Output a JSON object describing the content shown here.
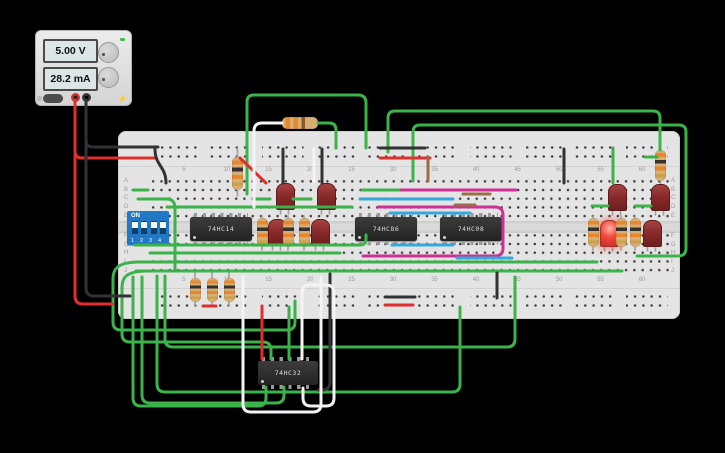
{
  "power_supply": {
    "voltage": "5.00 V",
    "current": "28.2 mA",
    "bolt_icon": "⚡"
  },
  "breadboard": {
    "row_labels_top": [
      "A",
      "B",
      "C",
      "D",
      "E"
    ],
    "row_labels_bottom": [
      "F",
      "G",
      "H",
      "I",
      "J"
    ],
    "column_labels": [
      5,
      10,
      15,
      20,
      25,
      30,
      35,
      40,
      45,
      50,
      55,
      60
    ]
  },
  "dip_switch": {
    "on_label": "ON",
    "positions_label": "1 2 3 4"
  },
  "ics": [
    {
      "label": "74HC14"
    },
    {
      "label": "74HC86"
    },
    {
      "label": "74HC08"
    },
    {
      "label": "74HC32"
    }
  ],
  "colors": {
    "g": "#3cb24a",
    "r": "#e02f2f",
    "k": "#323232",
    "w": "#f4f4f4",
    "m": "#cf3093",
    "c": "#35a7dc",
    "b": "#9c6b4a",
    "ld": "#9f9f9f",
    "board": "#e4e4e4",
    "dip_blue": "#2178c4",
    "led_lit": "#f4483c"
  },
  "wires": [
    {
      "n": "lead-led-1",
      "c": "ld",
      "l": "u",
      "p": "M280.5,205 V214 M288.5,205 V214"
    },
    {
      "n": "lead-led-2",
      "c": "ld",
      "l": "u",
      "p": "M321.5,205 V214 M329.5,205 V214"
    },
    {
      "n": "lead-led-3",
      "c": "ld",
      "l": "u",
      "p": "M272.5,241 V250 M280.5,241 V250"
    },
    {
      "n": "lead-led-4",
      "c": "ld",
      "l": "u",
      "p": "M315.5,241 V250 M323.5,241 V250"
    },
    {
      "n": "lead-led-5",
      "c": "ld",
      "l": "u",
      "p": "M612.5,206 V215 M620.5,206 V215"
    },
    {
      "n": "lead-led-6",
      "c": "ld",
      "l": "u",
      "p": "M655.5,206 V215 M663.5,206 V215"
    },
    {
      "n": "lead-led-7",
      "c": "ld",
      "l": "u",
      "p": "M604.5,242 V251 M612.5,242 V251"
    },
    {
      "n": "lead-led-8",
      "c": "ld",
      "l": "u",
      "p": "M647.5,242 V251 M655.5,242 V251"
    },
    {
      "n": "lead-res-top10",
      "c": "ld",
      "l": "u",
      "p": "M237.5,148 V196"
    },
    {
      "n": "lead-res-top61",
      "c": "ld",
      "l": "u",
      "p": "M660.5,149 V186"
    },
    {
      "n": "lead-res-bl",
      "c": "ld",
      "l": "u",
      "p": "M195,271 V306 M212,271 V306 M229,271 V306"
    },
    {
      "n": "lead-res-mid",
      "c": "ld",
      "l": "u",
      "p": "M262,216 V250 M288,216 V250 M304,216 V250"
    },
    {
      "n": "lead-res-right",
      "c": "ld",
      "l": "u",
      "p": "M593,216 V250 M621,216 V250 M635,216 V250"
    },
    {
      "n": "wire-green-arc-1",
      "c": "g",
      "l": "o",
      "p": "M247,194 V102 Q247,95 254,95 H358 Q366,95 366,103 V148"
    },
    {
      "n": "wire-green-arc-2",
      "c": "g",
      "l": "o",
      "p": "M388,152 V118 Q388,111 395,111 H653 Q660,111 660,118 V150"
    },
    {
      "n": "wire-green-arc-3",
      "c": "g",
      "l": "o",
      "p": "M413,181 V132 Q413,125 420,125 H679 Q686,125 686,132 V248 Q686,256 678,256 H637"
    },
    {
      "n": "wire-green-col56",
      "c": "g",
      "l": "o",
      "p": "M613,148 V183"
    },
    {
      "n": "wire-green-rowB",
      "c": "g",
      "l": "o",
      "p": "M133,190 H148"
    },
    {
      "n": "wire-green-rowC-down",
      "c": "g",
      "l": "o",
      "p": "M138,199 H168 Q175,200 175,208 V271"
    },
    {
      "n": "wire-green-rowD-long",
      "c": "g",
      "l": "o",
      "p": "M167,207 H352"
    },
    {
      "n": "wire-green-rowG",
      "c": "g",
      "l": "o",
      "p": "M135,245 H360 Q366,245 366,239 V235"
    },
    {
      "n": "wire-green-rowH",
      "c": "g",
      "l": "o",
      "p": "M150,253 H340"
    },
    {
      "n": "wire-green-rowI",
      "c": "g",
      "l": "o",
      "p": "M136,262 H597"
    },
    {
      "n": "wire-green-rowJ",
      "c": "g",
      "l": "o",
      "p": "M136,271 H622"
    },
    {
      "n": "wire-green-c15",
      "c": "g",
      "l": "o",
      "p": "M253,199 H270"
    },
    {
      "n": "wire-green-c20",
      "c": "g",
      "l": "o",
      "p": "M293,199 H311"
    },
    {
      "n": "wire-green-r55",
      "c": "g",
      "l": "o",
      "p": "M592,206 H608"
    },
    {
      "n": "wire-green-r60",
      "c": "g",
      "l": "o",
      "p": "M635,206 H651"
    },
    {
      "n": "wire-green-rail-r",
      "c": "g",
      "l": "o",
      "p": "M645,157 H657"
    },
    {
      "n": "wire-green-86",
      "c": "g",
      "l": "o",
      "p": "M362,190 H399"
    },
    {
      "n": "wire-green-reslead",
      "c": "g",
      "l": "o",
      "p": "M318,123 H329 Q336,123 336,130 V148"
    },
    {
      "n": "wire-green-loop-1",
      "c": "g",
      "l": "o",
      "p": "M140,262 C116,262 113,270 113,279 V322 Q113,330 121,330 H287 Q295,330 295,322 V301"
    },
    {
      "n": "wire-green-loop-2",
      "c": "g",
      "l": "o",
      "p": "M148,271 C124,271 122,279 122,288 V334 Q122,342 130,342 H263 Q271,342 271,350 V359"
    },
    {
      "n": "wire-green-loop-3",
      "c": "g",
      "l": "o",
      "p": "M165,276 V339 Q165,347 173,347 H507 Q515,347 515,339 V277"
    },
    {
      "n": "wire-green-loop-4",
      "c": "g",
      "l": "o",
      "p": "M157,276 V384 Q157,392 165,392 H452 Q460,392 460,384 V307"
    },
    {
      "n": "wire-green-or-pin1",
      "c": "g",
      "l": "o",
      "p": "M266,387 V398 Q266,406 258,406 H141 Q133,406 133,398 V277"
    },
    {
      "n": "wire-green-or-pin2",
      "c": "g",
      "l": "o",
      "p": "M284,387 V395 Q284,403 276,403 H150 Q142,403 142,395 V277"
    },
    {
      "n": "wire-green-or-top",
      "c": "g",
      "l": "o",
      "p": "M289,307 V359"
    },
    {
      "n": "wire-red-rail-top",
      "c": "r",
      "l": "o",
      "p": "M75,100 V151 Q75,158 82,158 H156"
    },
    {
      "n": "wire-red-rail-bot",
      "c": "r",
      "l": "o",
      "p": "M75,100 V296 Q75,304 83,304 H112"
    },
    {
      "n": "wire-red-seg-top",
      "c": "r",
      "l": "o",
      "p": "M380,158 H430"
    },
    {
      "n": "wire-red-seg-bl",
      "c": "r",
      "l": "o",
      "p": "M203,306 H216"
    },
    {
      "n": "wire-red-diag",
      "c": "r",
      "l": "o",
      "p": "M240,158 L266,183"
    },
    {
      "n": "wire-red-or",
      "c": "r",
      "l": "o",
      "p": "M262,306 V359"
    },
    {
      "n": "wire-red-seg-bot",
      "c": "r",
      "l": "o",
      "p": "M385,305 H413"
    },
    {
      "n": "wire-black-rail-top",
      "c": "k",
      "l": "o",
      "p": "M86,100 V141 Q86,147 93,147 H158"
    },
    {
      "n": "wire-black-rail-bot",
      "c": "k",
      "l": "o",
      "p": "M86,100 V288 Q86,296 94,296 H130"
    },
    {
      "n": "wire-black-s",
      "c": "k",
      "l": "o",
      "p": "M155,149 C155,166 166,166 166,183"
    },
    {
      "n": "wire-black-seg-top",
      "c": "k",
      "l": "o",
      "p": "M380,148 H425"
    },
    {
      "n": "wire-black-c16",
      "c": "k",
      "l": "o",
      "p": "M283,149 V183"
    },
    {
      "n": "wire-black-c21",
      "c": "k",
      "l": "o",
      "p": "M322,149 V183"
    },
    {
      "n": "wire-black-c41",
      "c": "k",
      "l": "o",
      "p": "M497,273 V298"
    },
    {
      "n": "wire-black-seg-bot",
      "c": "k",
      "l": "o",
      "p": "M385,297 H415"
    },
    {
      "n": "wire-black-or-loop",
      "c": "k",
      "l": "o",
      "p": "M330,274 V382 Q330,390 322,390 H318"
    },
    {
      "n": "wire-black-c50",
      "c": "k",
      "l": "o",
      "p": "M564,149 V183"
    },
    {
      "n": "wire-white-res",
      "c": "w",
      "l": "o",
      "p": "M282,123 H262 Q254,123 254,131 V207"
    },
    {
      "n": "wire-white-loop-big",
      "c": "w",
      "l": "o",
      "p": "M243,276 V404 Q243,412 251,412 H313 Q321,412 321,404 V277"
    },
    {
      "n": "wire-white-or-loop",
      "c": "w",
      "l": "o",
      "p": "M302,359 V293 Q302,285 310,285 H326 Q334,285 334,293 V398 Q334,406 326,406 H311 Q303,406 303,398 V388"
    },
    {
      "n": "wire-white-c20",
      "c": "w",
      "l": "o",
      "p": "M314,149 V181"
    },
    {
      "n": "wire-magenta-rowB",
      "c": "m",
      "l": "o",
      "p": "M401,190 H516"
    },
    {
      "n": "wire-magenta-rowD",
      "c": "m",
      "l": "o",
      "p": "M378,207 H495 Q503,207 503,215 V248 Q503,256 495,256 H363"
    },
    {
      "n": "wire-cyan-rowC",
      "c": "c",
      "l": "o",
      "p": "M360,199 H453"
    },
    {
      "n": "wire-cyan-rowE",
      "c": "c",
      "l": "o",
      "p": "M390,213 H470"
    },
    {
      "n": "wire-cyan-rowG",
      "c": "c",
      "l": "o",
      "p": "M392,245 H453"
    },
    {
      "n": "wire-cyan-rowH",
      "c": "c",
      "l": "o",
      "p": "M457,258 H512"
    },
    {
      "n": "wire-brown-rail",
      "c": "b",
      "l": "o",
      "p": "M428,157 V181"
    },
    {
      "n": "wire-brown-rowB",
      "c": "b",
      "l": "o",
      "p": "M463,194 H490"
    },
    {
      "n": "wire-brown-rowD",
      "c": "b",
      "l": "o",
      "p": "M455,205 H475"
    }
  ]
}
